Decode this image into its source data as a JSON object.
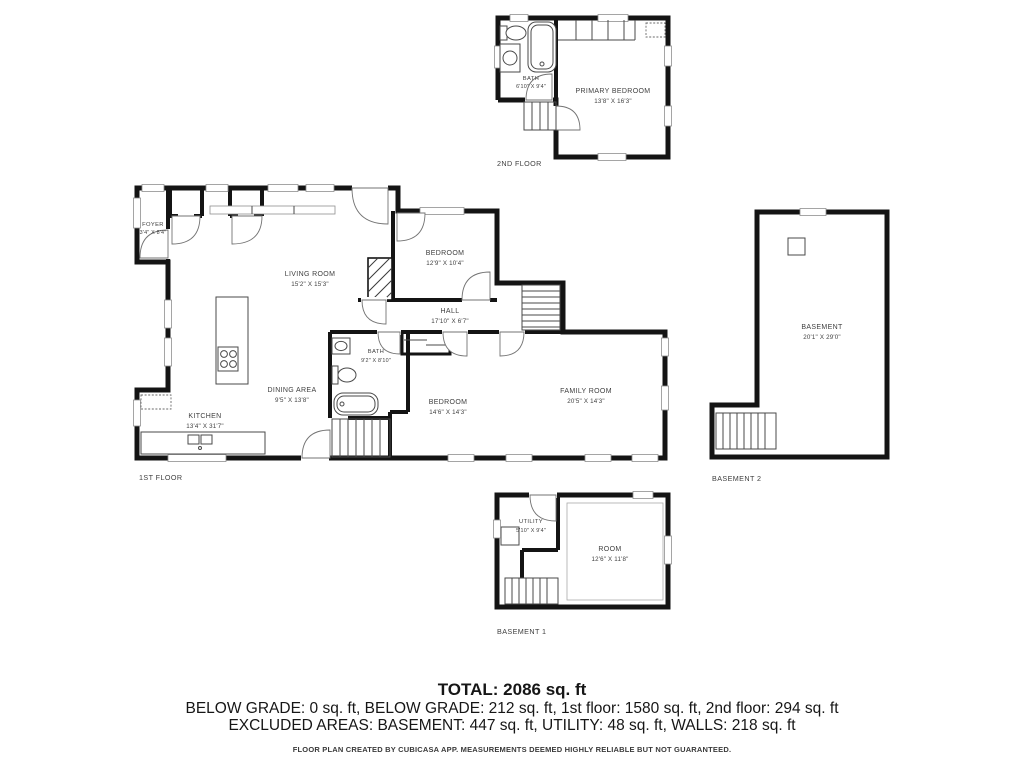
{
  "floors": {
    "second": {
      "label": "2ND FLOOR",
      "rooms": {
        "bath": {
          "name": "BATH",
          "dims": "6'10\" X 9'4\""
        },
        "primary_bedroom": {
          "name": "PRIMARY BEDROOM",
          "dims": "13'8\" X 16'3\""
        }
      }
    },
    "first": {
      "label": "1ST FLOOR",
      "rooms": {
        "foyer": {
          "name": "FOYER",
          "dims": "3'4\" X 8'4\""
        },
        "living_room": {
          "name": "LIVING ROOM",
          "dims": "15'2\" X 15'3\""
        },
        "bedroom_upper": {
          "name": "BEDROOM",
          "dims": "12'9\" X 10'4\""
        },
        "hall": {
          "name": "HALL",
          "dims": "17'10\" X 6'7\""
        },
        "bath": {
          "name": "BATH",
          "dims": "9'2\" X 8'10\""
        },
        "dining_area": {
          "name": "DINING AREA",
          "dims": "9'5\" X 13'8\""
        },
        "kitchen": {
          "name": "KITCHEN",
          "dims": "13'4\" X 31'7\""
        },
        "bedroom_lower": {
          "name": "BEDROOM",
          "dims": "14'6\" X 14'3\""
        },
        "family_room": {
          "name": "FAMILY ROOM",
          "dims": "20'5\" X 14'3\""
        }
      }
    },
    "basement2": {
      "label": "BASEMENT 2",
      "rooms": {
        "basement": {
          "name": "BASEMENT",
          "dims": "20'1\" X 29'0\""
        }
      }
    },
    "basement1": {
      "label": "BASEMENT 1",
      "rooms": {
        "utility": {
          "name": "UTILITY",
          "dims": "5'10\" X 9'4\""
        },
        "room": {
          "name": "ROOM",
          "dims": "12'6\" X 11'8\""
        }
      }
    }
  },
  "summary": {
    "total": "TOTAL: 2086 sq. ft",
    "areas_line": "BELOW GRADE: 0 sq. ft, BELOW GRADE: 212 sq. ft, 1st floor: 1580 sq. ft, 2nd floor: 294 sq. ft",
    "excluded_line": "EXCLUDED AREAS: BASEMENT: 447 sq. ft, UTILITY: 48 sq. ft, WALLS: 218 sq. ft",
    "disclaimer": "FLOOR PLAN CREATED BY CUBICASA APP. MEASUREMENTS DEEMED HIGHLY RELIABLE BUT NOT GUARANTEED."
  }
}
